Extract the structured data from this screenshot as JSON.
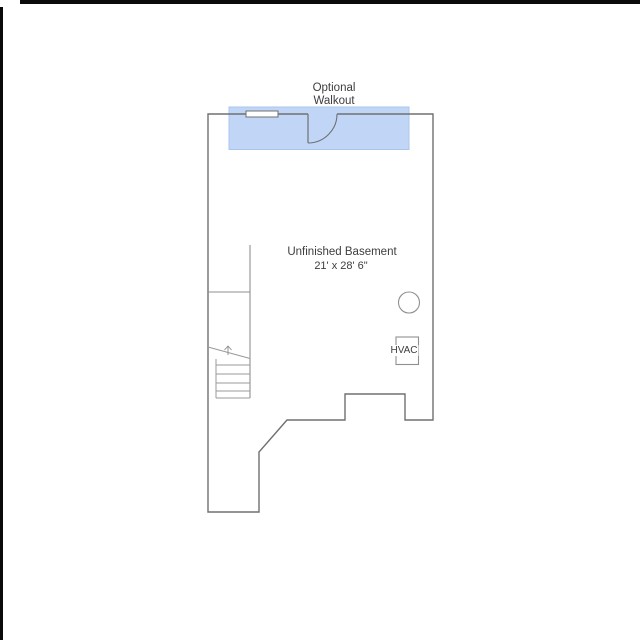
{
  "page": {
    "width": 640,
    "height": 640,
    "background": "#ffffff"
  },
  "frame": {
    "border_color": "#0a0a0a"
  },
  "floorplan": {
    "labels": {
      "walkout_line1": "Optional",
      "walkout_line2": "Walkout",
      "room_name": "Unfinished Basement",
      "room_dimensions": "21' x 28' 6\"",
      "hvac": "HVAC"
    },
    "colors": {
      "wall": "#707070",
      "interior_line": "#8f8f8f",
      "tread_line": "#9a9a9a",
      "text": "#3d3d3d",
      "highlight_fill": "#c1d6f7",
      "highlight_border": "#aac5ec"
    }
  }
}
